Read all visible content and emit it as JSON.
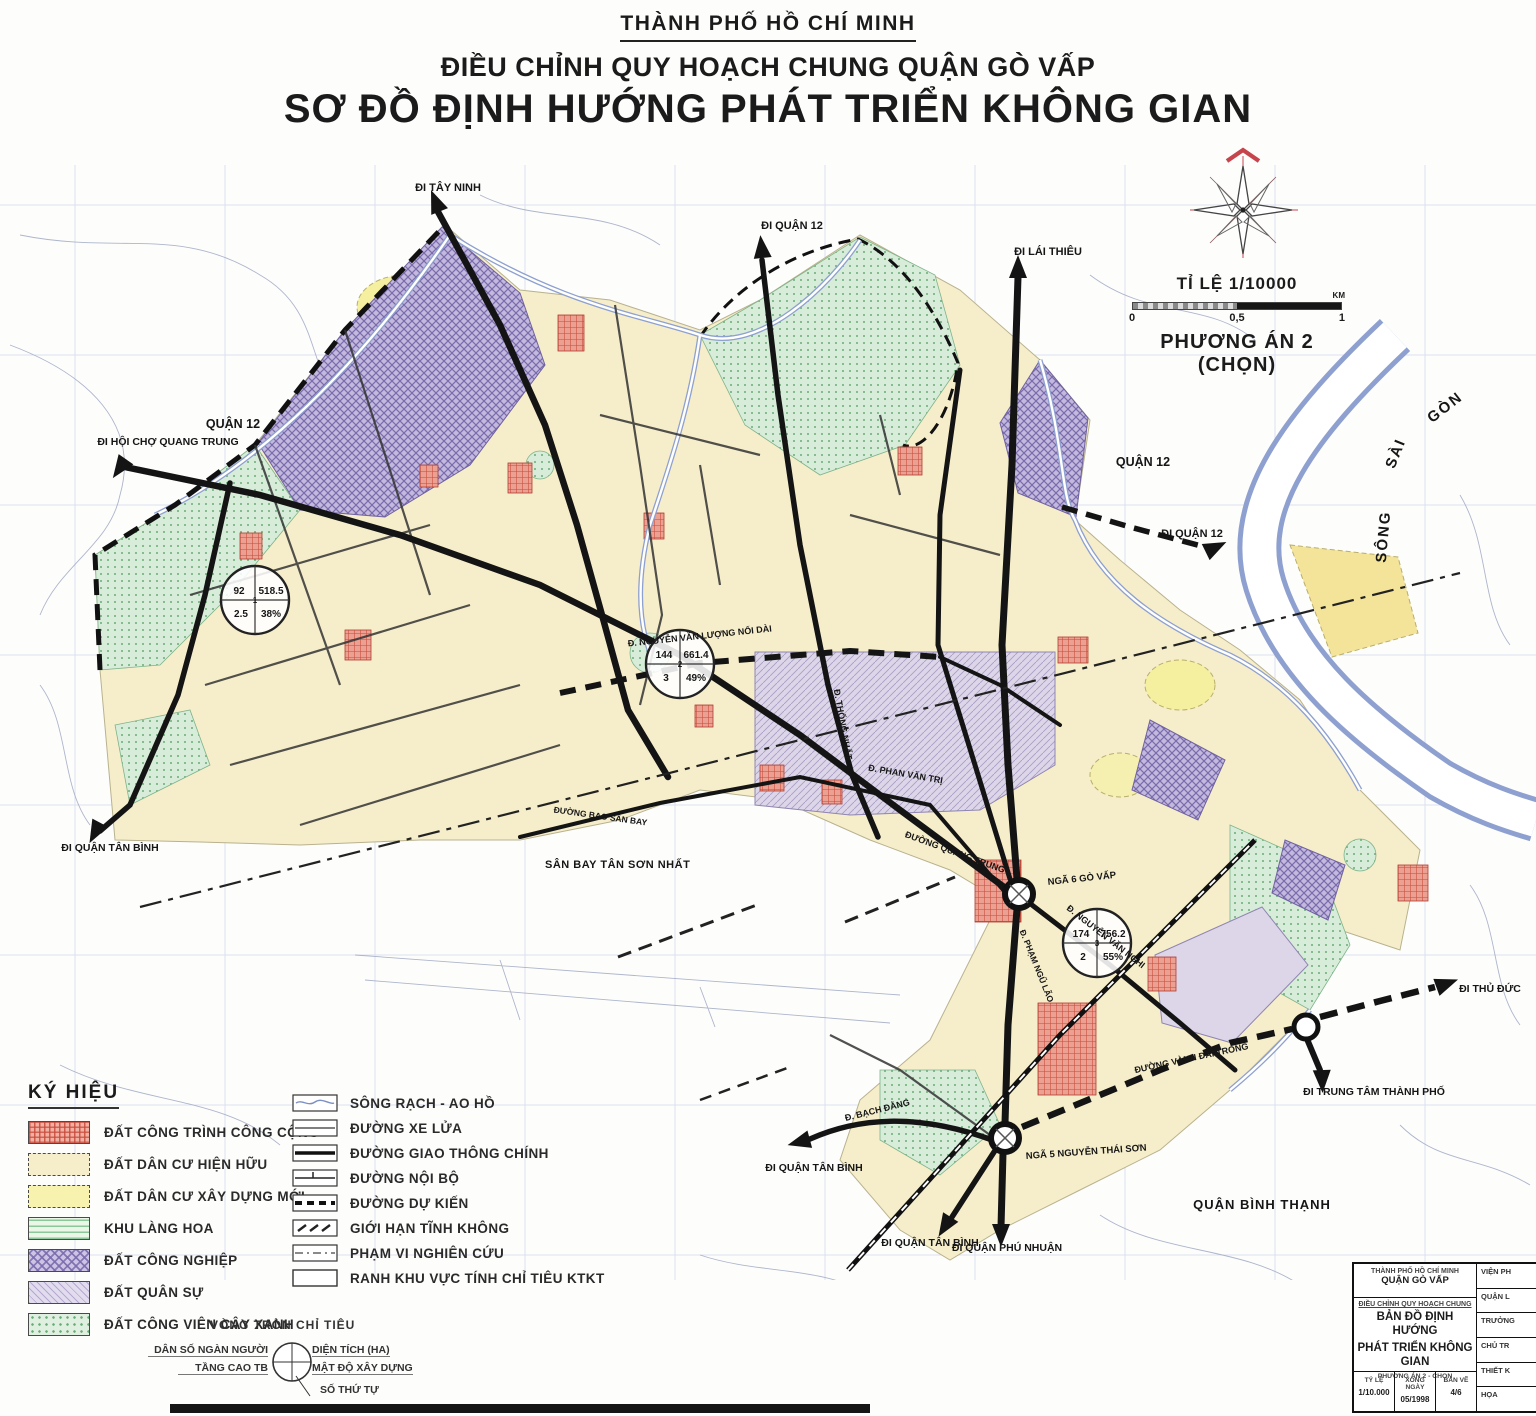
{
  "header": {
    "city": "THÀNH PHỐ HỒ CHÍ MINH",
    "subtitle": "ĐIỀU CHỈNH QUY HOẠCH CHUNG QUẬN GÒ VẤP",
    "title": "SƠ ĐỒ ĐỊNH HƯỚNG PHÁT TRIỂN KHÔNG GIAN"
  },
  "scale": {
    "label": "TỈ LỆ 1/10000",
    "tick0": "0",
    "tick_mid": "0,5",
    "tick1": "1",
    "unit": "KM",
    "variant": "PHƯƠNG ÁN 2 (CHỌN)"
  },
  "legend": {
    "title": "KÝ HIỆU",
    "area_items": [
      {
        "label": "ĐẤT CÔNG TRÌNH CÔNG CỘNG"
      },
      {
        "label": "ĐẤT DÂN CƯ HIỆN HỮU"
      },
      {
        "label": "ĐẤT DÂN CƯ XÂY DỰNG MỚI"
      },
      {
        "label": "KHU LÀNG HOA"
      },
      {
        "label": "ĐẤT CÔNG NGHIỆP"
      },
      {
        "label": "ĐẤT QUÂN SỰ"
      },
      {
        "label": "ĐẤT CÔNG VIÊN CÂY XANH"
      }
    ],
    "line_items": [
      {
        "label": "SÔNG RẠCH - AO HỒ"
      },
      {
        "label": "ĐƯỜNG XE LỬA"
      },
      {
        "label": "ĐƯỜNG GIAO THÔNG CHÍNH"
      },
      {
        "label": "ĐƯỜNG NỘI BỘ"
      },
      {
        "label": "ĐƯỜNG DỰ KIẾN"
      },
      {
        "label": "GIỚI HẠN TĨNH KHÔNG"
      },
      {
        "label": "PHẠM VI NGHIÊN CỨU"
      },
      {
        "label": "RANH KHU VỰC TÍNH CHỈ TIÊU KTKT"
      }
    ]
  },
  "indicator_legend": {
    "title": "VÒNG TRÒN CHỈ TIÊU",
    "pop": "DÂN SỐ NGÀN NGƯỜI",
    "floors": "TẦNG CAO TB",
    "area": "DIỆN TÍCH (HA)",
    "density": "MẬT ĐỘ XÂY DỰNG",
    "seq": "SỐ THỨ TỰ"
  },
  "circles": [
    {
      "seq": "1",
      "pop": "92",
      "area": "518.5",
      "floors": "2.5",
      "density": "38%"
    },
    {
      "seq": "2",
      "pop": "144",
      "area": "661.4",
      "floors": "3",
      "density": "49%"
    },
    {
      "seq": "3",
      "pop": "174",
      "area": "756.2",
      "floors": "2",
      "density": "55%"
    }
  ],
  "map_labels": {
    "di_tay_ninh": "ĐI TÂY NINH",
    "di_quan_12_top": "ĐI QUẬN 12",
    "di_lai_thieu": "ĐI LÁI THIÊU",
    "di_quan_12_east": "ĐI QUẬN 12",
    "quan_12_nw": "QUẬN 12",
    "quan_12_ne": "QUẬN 12",
    "song_1": "SÔNG",
    "song_2": "SÀI",
    "song_3": "GÒN",
    "di_hoi_cho": "ĐI HỘI CHỢ QUANG TRUNG",
    "di_tan_binh_w": "ĐI QUẬN TÂN BÌNH",
    "san_bay": "SÂN BAY TÂN SƠN NHẤT",
    "nga6": "NGÃ 6 GÒ VẤP",
    "nga5": "NGÃ 5 NGUYỄN THÁI SƠN",
    "quan_binh_thanh": "QUẬN BÌNH THẠNH",
    "di_tan_binh_s1": "ĐI QUẬN TÂN BÌNH",
    "di_tan_binh_s2": "ĐI QUẬN TÂN BÌNH",
    "di_phu_nhuan": "ĐI QUẬN PHÚ NHUẬN",
    "di_trung_tam": "ĐI TRUNG TÂM THÀNH PHỐ",
    "di_thu_duc": "ĐI THỦ ĐỨC",
    "d_bach_dang": "Đ. BẠCH ĐẰNG",
    "d_quang_trung": "ĐƯỜNG QUANG TRUNG",
    "d_nguyen_van_nghi": "Đ. NGUYỄN VĂN NGHI",
    "d_pham_ngu_lao": "Đ. PHẠM NGŨ LÃO",
    "d_nvl_noi_dai": "Đ. NGUYỄN VĂN LƯỢNG NỐI DÀI",
    "d_thong_nhat": "Đ. THỐNG NHẤT",
    "d_phan_van_tri": "Đ. PHAN VĂN TRỊ",
    "d_vanh_dai": "ĐƯỜNG VÀNH ĐAI TRONG",
    "d_bao_san_bay": "ĐƯỜNG BAO SÂN BAY"
  },
  "title_block": {
    "org1": "THÀNH PHỐ HỒ CHÍ MINH",
    "org2": "QUẬN GÒ VẤP",
    "project": "ĐIỀU CHỈNH QUY HOẠCH CHUNG",
    "map1": "BẢN ĐỒ ĐỊNH HƯỚNG",
    "map2": "PHÁT TRIỂN KHÔNG GIAN",
    "variant": "PHƯƠNG ÁN 2 - CHỌN",
    "c1l": "TỶ LỆ",
    "c1v": "1/10.000",
    "c2l": "XONG NGÀY",
    "c2v": "05/1998",
    "c3l": "BẢN VẼ",
    "c3v": "4/6",
    "side": [
      {
        "label": "VIỆN PH"
      },
      {
        "label": "QUẬN L"
      },
      {
        "label": "TRƯỞNG"
      },
      {
        "label": "CHỦ TR"
      },
      {
        "label": "THIẾT K"
      },
      {
        "label": "HỌA"
      }
    ]
  },
  "colors": {
    "road": "#141414",
    "water": "#8ea0cf",
    "public_works": "#eba092",
    "residential_existing": "#f6eecb",
    "residential_new": "#f7f2ae",
    "industrial": "#c3b8dd",
    "military": "#dcd6e8",
    "park_green": "#d7ecd9",
    "compass_red": "#c6454d"
  }
}
